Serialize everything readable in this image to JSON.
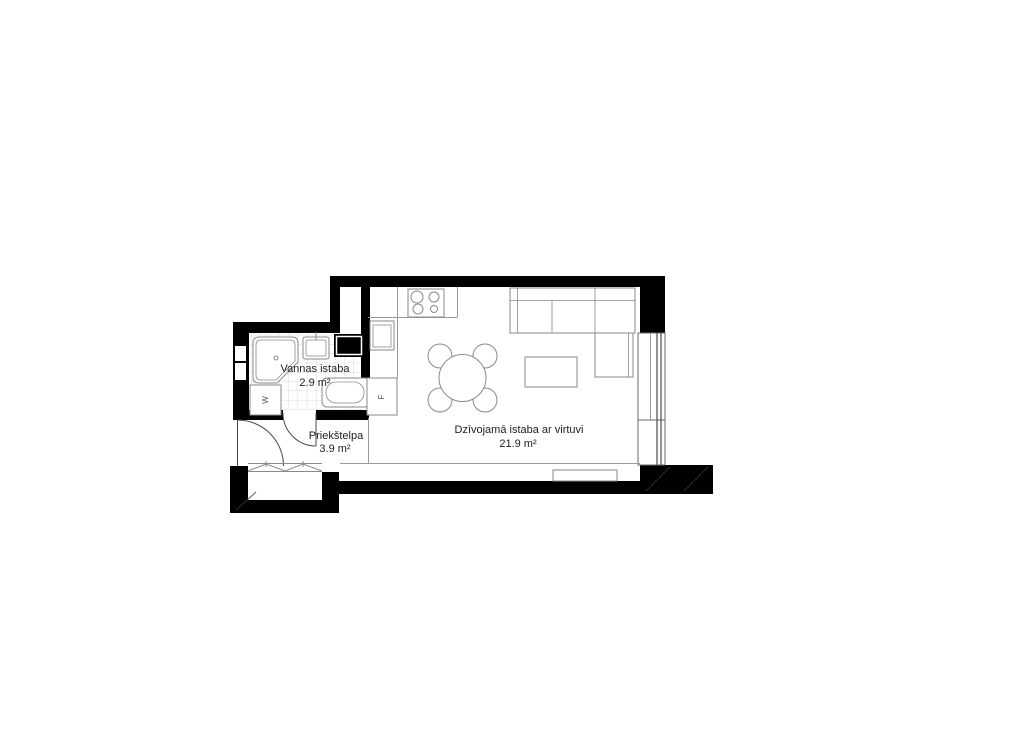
{
  "floorplan": {
    "rooms": [
      {
        "name": "Vannas istaba",
        "area": "2.9 m²"
      },
      {
        "name": "Priekštelpa",
        "area": "3.9 m²"
      },
      {
        "name": "Dzīvojamā istaba ar virtuvi",
        "area": "21.9 m²"
      }
    ],
    "appliances": {
      "washer_label": "W",
      "fridge_label": "F"
    },
    "colors": {
      "wall": "#000000",
      "furniture_line": "#8a8a8a",
      "boundary_line": "#9a9a9a",
      "tile_line": "#d9d9d9",
      "glass": "#47523f",
      "background": "#ffffff",
      "text": "#1f1f1f"
    }
  }
}
